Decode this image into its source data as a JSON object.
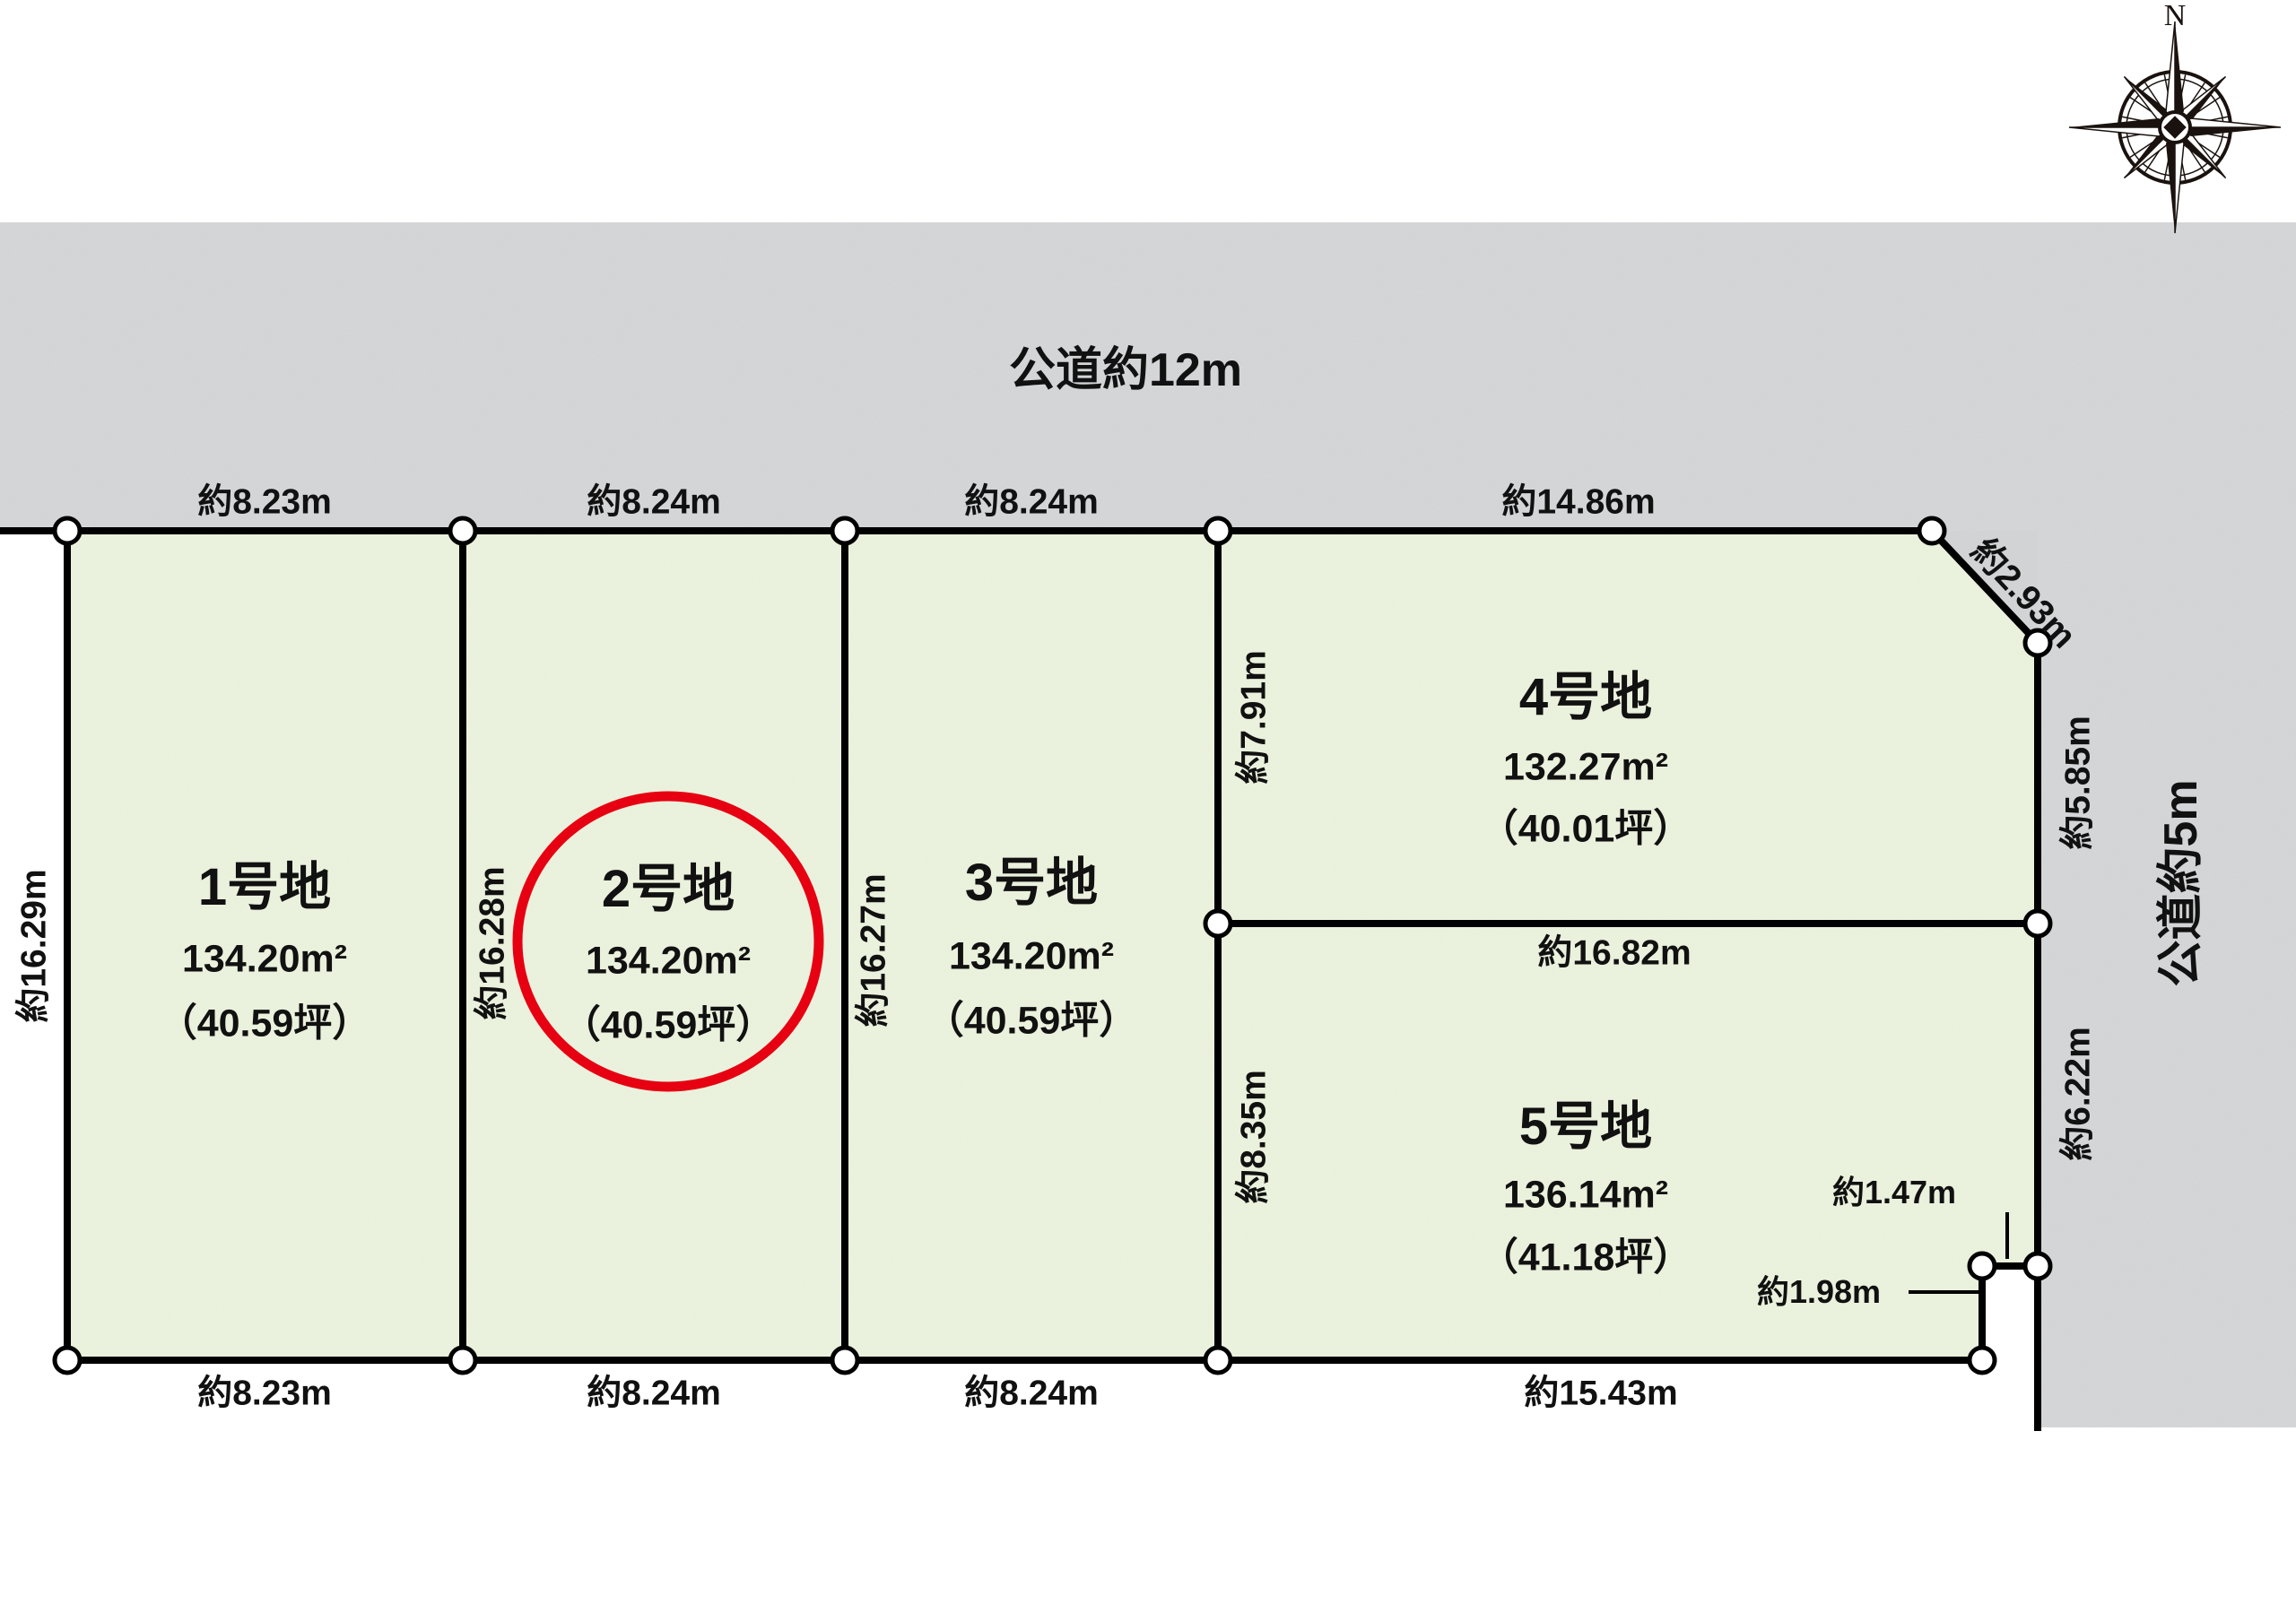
{
  "roads": {
    "top_label": "公道約12m",
    "right_label": "公道約5m"
  },
  "compass": {
    "north_label": "N"
  },
  "plots": [
    {
      "name": "1号地",
      "area_m2": "134.20m²",
      "area_tsubo": "（40.59坪）"
    },
    {
      "name": "2号地",
      "area_m2": "134.20m²",
      "area_tsubo": "（40.59坪）"
    },
    {
      "name": "3号地",
      "area_m2": "134.20m²",
      "area_tsubo": "（40.59坪）"
    },
    {
      "name": "4号地",
      "area_m2": "132.27m²",
      "area_tsubo": "（40.01坪）"
    },
    {
      "name": "5号地",
      "area_m2": "136.14m²",
      "area_tsubo": "（41.18坪）"
    }
  ],
  "dimensions": {
    "top": [
      "約8.23m",
      "約8.24m",
      "約8.24m",
      "約14.86m"
    ],
    "bottom": [
      "約8.23m",
      "約8.24m",
      "約8.24m",
      "約15.43m"
    ],
    "left_outer": "約16.29m",
    "plot2_left": "約16.28m",
    "plot3_left": "約16.27m",
    "plot4_left": "約7.91m",
    "plot5_left": "約8.35m",
    "corner_cut": "約2.93m",
    "right_upper": "約5.85m",
    "right_lower": "約6.22m",
    "between_plots_4_5": "約16.82m",
    "notch_width": "約1.47m",
    "notch_depth": "約1.98m"
  },
  "colors": {
    "plot_fill": "#e9f0da",
    "road_fill": "#d2d3d5",
    "line": "#000000",
    "highlight_red": "#e60012"
  }
}
